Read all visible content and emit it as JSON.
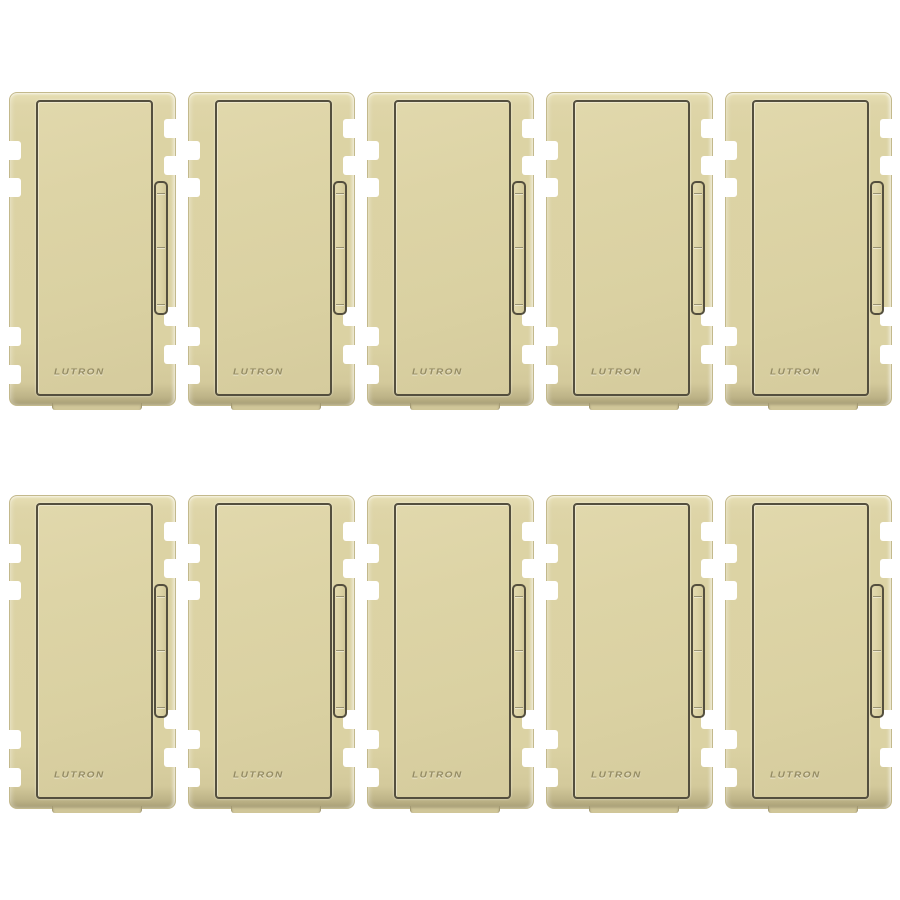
{
  "product": {
    "brand_label": "LUTRON",
    "grid": {
      "rows": 2,
      "cols": 5,
      "count": 10
    }
  },
  "switches": [
    {
      "brand_label": "LUTRON"
    },
    {
      "brand_label": "LUTRON"
    },
    {
      "brand_label": "LUTRON"
    },
    {
      "brand_label": "LUTRON"
    },
    {
      "brand_label": "LUTRON"
    },
    {
      "brand_label": "LUTRON"
    },
    {
      "brand_label": "LUTRON"
    },
    {
      "brand_label": "LUTRON"
    },
    {
      "brand_label": "LUTRON"
    },
    {
      "brand_label": "LUTRON"
    }
  ],
  "colors": {
    "background": "#ffffff",
    "plate_ivory": "#dcd3a4",
    "plate_highlight": "#e7dfb4",
    "plate_shadow": "#a79d74",
    "plate_outline": "#c3b98c",
    "seam_dark": "#544f3e",
    "slider_fill": "#ddd4a6",
    "notch_white": "#ffffff",
    "emboss": "#7d744c"
  }
}
